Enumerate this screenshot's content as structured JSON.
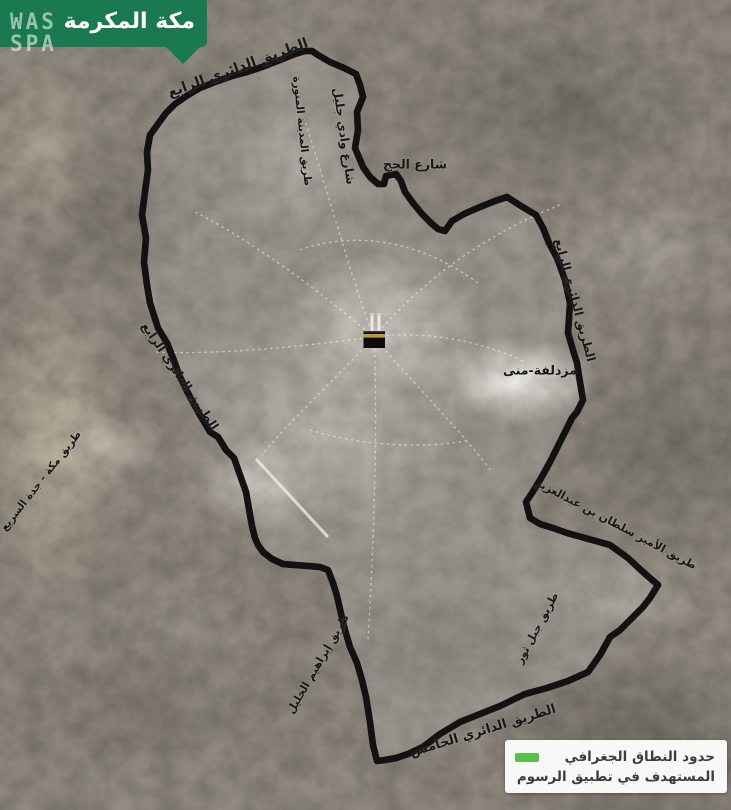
{
  "banner": {
    "title": "مكة المكرمة"
  },
  "watermark": {
    "line1": "WAS",
    "line2": "SPA"
  },
  "colors": {
    "banner_green": "#1a7950",
    "boundary_green": "#5abf4a",
    "boundary_casing": "#121212",
    "kaaba_band_gold": "#b89a3e",
    "label_text": "#171717",
    "legend_background": "#ffffff"
  },
  "legend": {
    "line1": "حدود النطاق الجغرافي",
    "line2": "المستهدف في تطبيق الرسوم"
  },
  "map": {
    "labels": [
      {
        "name": "ring-road-4-north",
        "text": "الطريق الدائري الرابع"
      },
      {
        "name": "madinah-road",
        "text": "طريق المدينة المنورة"
      },
      {
        "name": "wadi-jalil-street",
        "text": "شارع وادي جليل"
      },
      {
        "name": "hajj-street",
        "text": "شارع الحج"
      },
      {
        "name": "ring-road-4-east",
        "text": "الطريق الدائري الرابع"
      },
      {
        "name": "muzdalifah-mina",
        "text": "مزدلفة-منى"
      },
      {
        "name": "prince-sultan-bin-abdulaziz-road",
        "text": "طريق الأمير سلطان بن عبدالعزيز"
      },
      {
        "name": "jabal-thawr-road",
        "text": "طريق جبل ثور"
      },
      {
        "name": "makkah-jeddah-expressway",
        "text": "طريق مكة - جدة السريع"
      },
      {
        "name": "ring-road-4-west",
        "text": "الطريق الدائري الرابع"
      },
      {
        "name": "ibrahim-al-khalil-road",
        "text": "طريق إبراهيم الخليل"
      },
      {
        "name": "ring-road-5-south",
        "text": "الطريق الدائري الخامس"
      }
    ]
  }
}
